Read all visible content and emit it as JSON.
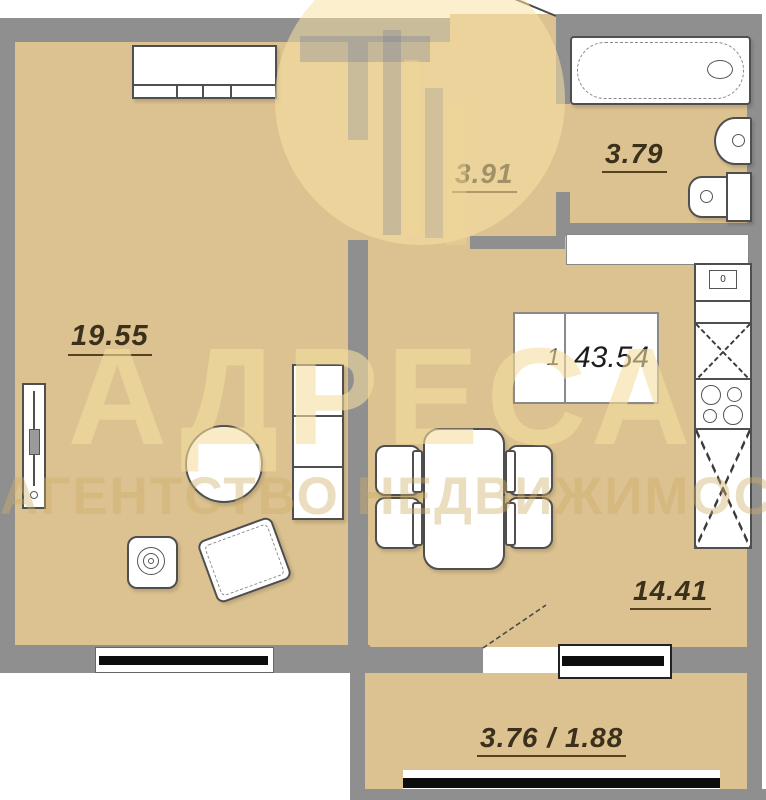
{
  "plan_title": "1-room apartment floor plan",
  "rooms": {
    "living": {
      "label": "19.55"
    },
    "hall": {
      "label": "3.91"
    },
    "bath": {
      "label": "3.79"
    },
    "kitchen": {
      "label": "14.41"
    },
    "balcony": {
      "label": "3.76 / 1.88"
    }
  },
  "area_box": {
    "number": "1",
    "area": "43.54"
  },
  "kitchen_unit": {
    "label": "0"
  },
  "watermark": {
    "title": "АДРЕСА",
    "subtitle": "АГЕНТСТВО НЕДВИЖИМОСТИ"
  },
  "colors": {
    "floor": "#dcc290",
    "wall": "#8f8f8f",
    "label_text": "#3a301c",
    "watermark_cream": "#f4dd9e",
    "window_glass": "#0d0d0d"
  }
}
